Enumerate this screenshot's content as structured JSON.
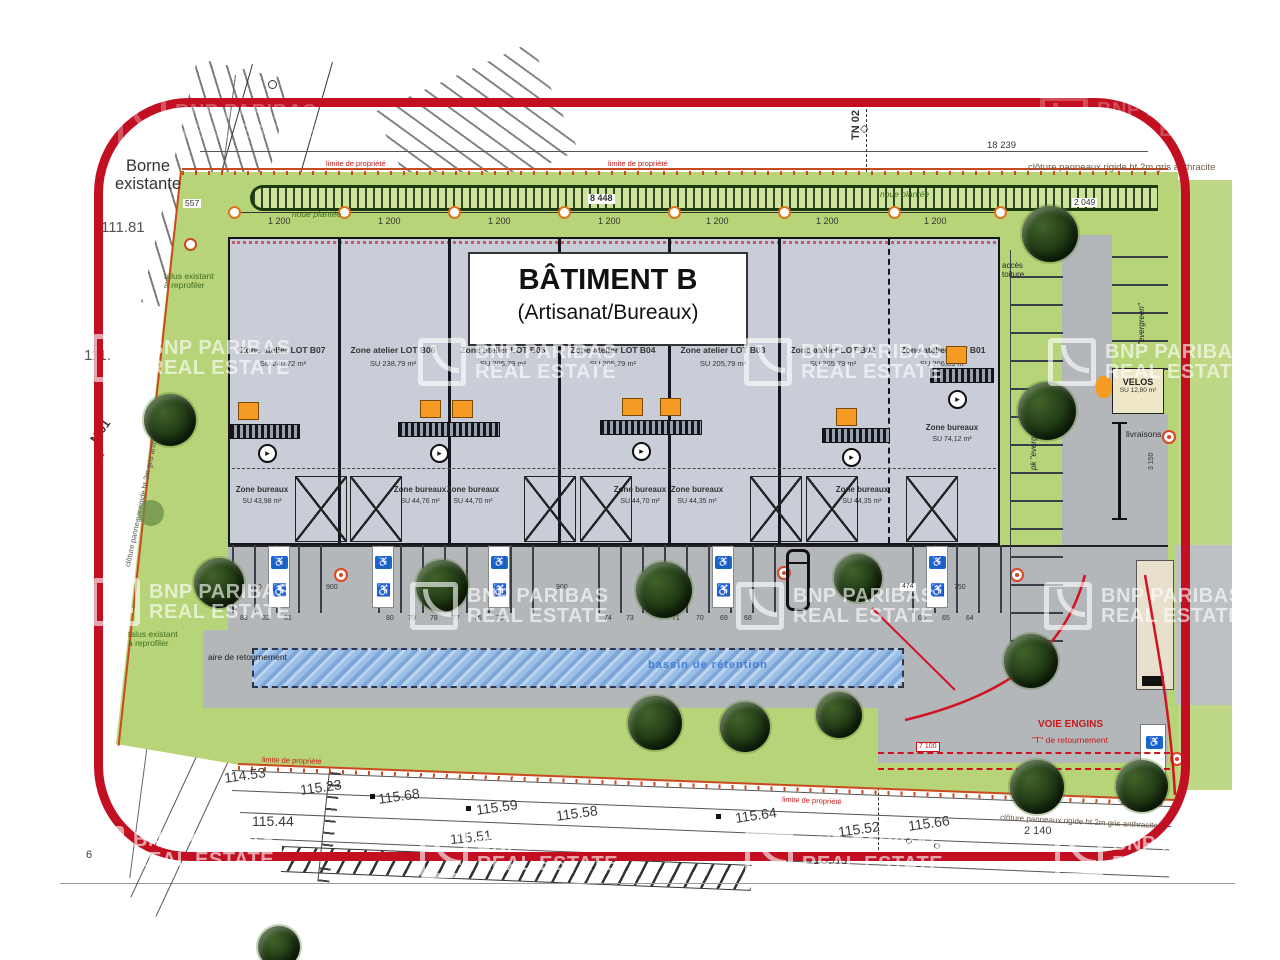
{
  "title": {
    "line1": "BÂTIMENT B",
    "line2": "(Artisanat/Bureaux)"
  },
  "lots": [
    {
      "name": "Zone atelier LOT B07",
      "area": "SU 240,72 m²"
    },
    {
      "name": "Zone atelier LOT B06",
      "area": "SU 238,79 m²"
    },
    {
      "name": "Zone atelier LOT B05",
      "area": "SU 205,79 m²"
    },
    {
      "name": "Zone atelier LOT B04",
      "area": "SU 205,79 m²"
    },
    {
      "name": "Zone atelier LOT B03",
      "area": "SU 205,79 m²"
    },
    {
      "name": "Zone atelier LOT B02",
      "area": "SU 205,79 m²"
    },
    {
      "name": "Zone atelier LOT B01",
      "area": "SU 206,89 m²"
    }
  ],
  "bureaux": [
    {
      "label": "Zone bureaux",
      "area": "SU 43,98 m²"
    },
    {
      "label": "Zone bureaux",
      "area": "SU 44,76 m²"
    },
    {
      "label": "Zone bureaux",
      "area": "SU 44,70 m²"
    },
    {
      "label": "Zone bureaux",
      "area": "SU 44,70 m²"
    },
    {
      "label": "Zone bureaux",
      "area": "SU 44,35 m²"
    },
    {
      "label": "Zone bureaux",
      "area": "SU 44,35 m²"
    },
    {
      "label": "Zone bureaux",
      "area": "SU 74,12 m²"
    }
  ],
  "labels": {
    "borne": "Borne existante",
    "elev_a": "111.81",
    "elev_b": "111.",
    "n01": "N 01",
    "tn02": "TN 02",
    "talus": "talus existant à reprofiler",
    "aire": "aire de retournement",
    "acces": "accès toiture",
    "noue": "noue plantée",
    "bassin": "bassin de rétention",
    "velos": "VELOS",
    "velos_area": "SU 12,80 m²",
    "livraisons": "livraisons",
    "evergreen_l": "pk \"evergreen\"",
    "evergreen_r": "\"evergreen\"",
    "voie_1": "VOIE ENGINS",
    "voie_2": "\"T\" de retournement",
    "limite": "limite de propriété",
    "cloture": "clôture panneaux rigide ht 2m gris anthracite",
    "left_mark": "6"
  },
  "dims": {
    "d18239": "18 239",
    "d8448": "8 448",
    "d2049": "2 049",
    "d1200": "1 200",
    "d557": "557",
    "d900": "900",
    "d750": "750",
    "d1503": "1 503",
    "d474": "474",
    "d3150": "3 150",
    "d7100": "7 100",
    "d2140": "2 140"
  },
  "parking": {
    "stalls": [
      "83",
      "82",
      "81",
      "80",
      "79",
      "78",
      "77",
      "76",
      "75",
      "74",
      "73",
      "71",
      "70",
      "69",
      "68",
      "66",
      "65",
      "64"
    ]
  },
  "survey": {
    "elevations": [
      "114.53",
      "115.23",
      "115.68",
      "115.59",
      "115.58",
      "115.44",
      "115.51",
      "115.64",
      "115.52",
      "115.66",
      "115.59"
    ]
  },
  "watermark": {
    "line1": "BNP PARIBAS",
    "line2": "REAL ESTATE"
  },
  "colors": {
    "frame_red": "#c21022",
    "green": "#b7d478",
    "building_gray": "#c9cdd8",
    "asphalt": "#b4b7ba",
    "orange": "#f59a23",
    "handicap_blue": "#1669c9",
    "bassin_blue": "#8fb4e3",
    "boundary_orange": "#c94a1d"
  }
}
